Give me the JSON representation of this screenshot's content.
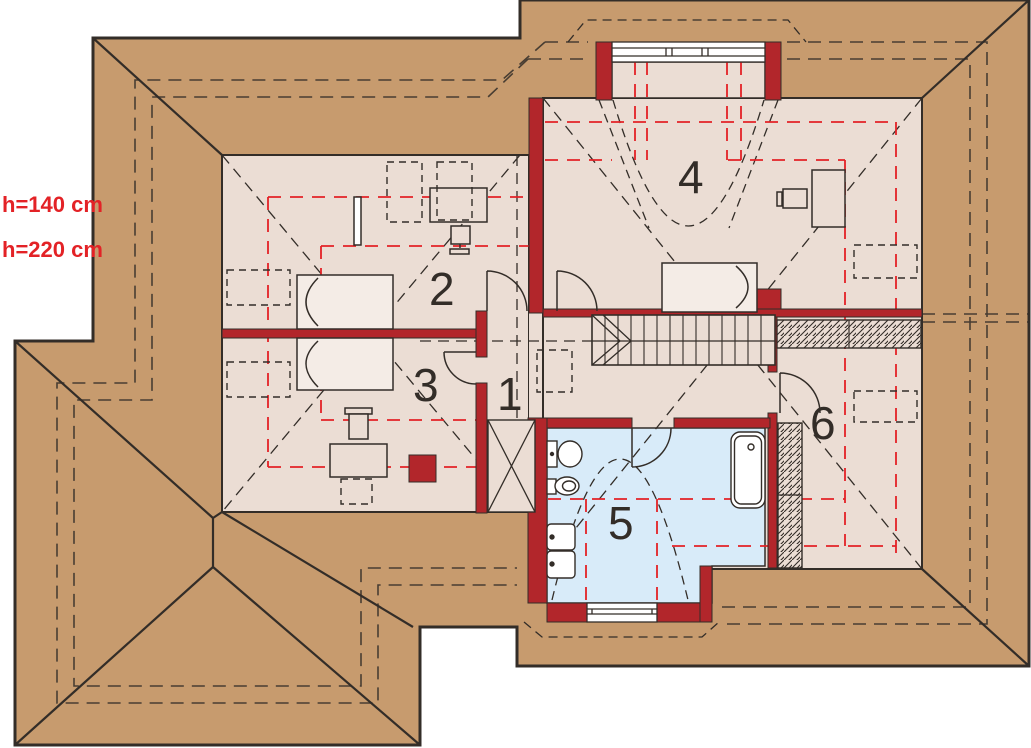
{
  "page": {
    "background": "#ffffff"
  },
  "colors": {
    "page_background": "#ffffff",
    "roof": "#c79b6e",
    "floor": "#ebddd4",
    "bathroom_floor": "#d8ebf9",
    "wall_red": "#b2262b",
    "height_line_red": "#e32226",
    "line_dark": "#332d28",
    "furniture_fill": "#f4ece6",
    "window_fill": "#ffffff"
  },
  "labels": {
    "height_line_1": "h=140 cm",
    "height_line_2": "h=220 cm"
  },
  "rooms": [
    {
      "label": "1"
    },
    {
      "label": "2"
    },
    {
      "label": "3"
    },
    {
      "label": "4"
    },
    {
      "label": "5"
    },
    {
      "label": "6"
    }
  ]
}
